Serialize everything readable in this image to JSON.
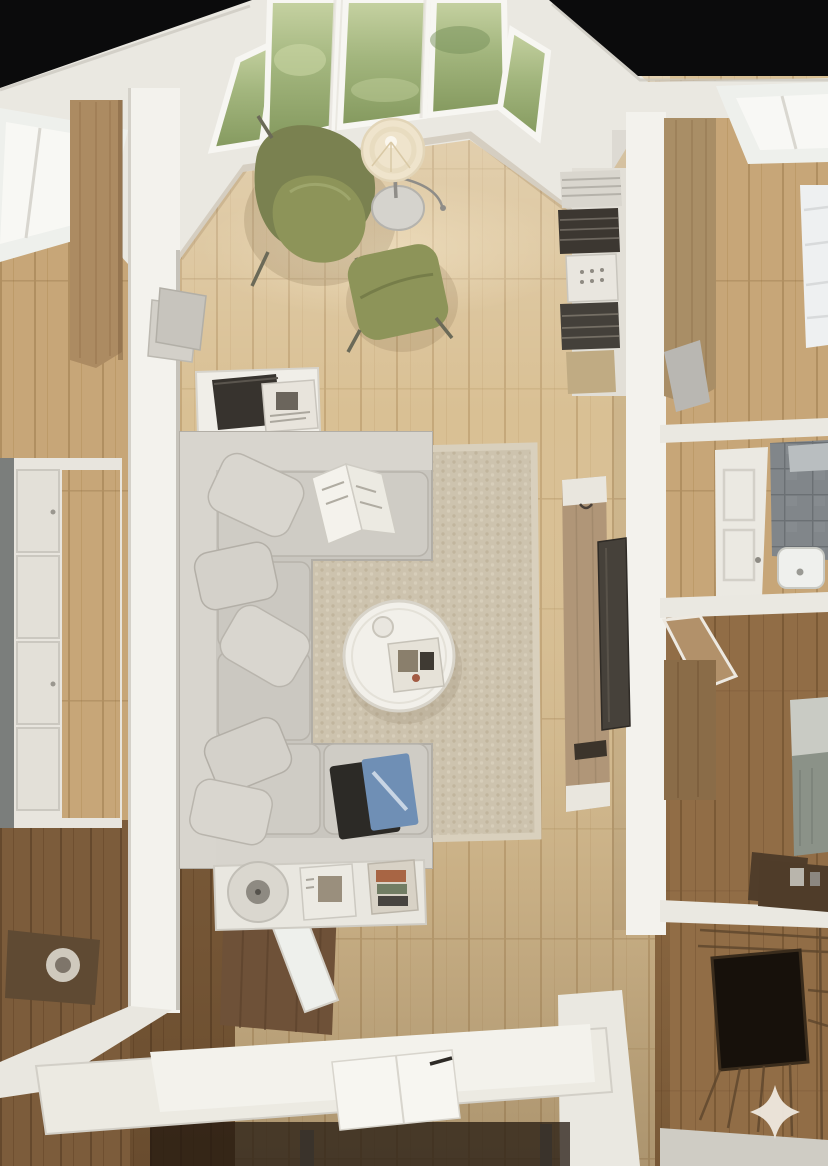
{
  "meta": {
    "type": "photorealistic-3d-render",
    "view": "top-down-birds-eye",
    "subject": "apartment interior with central living room, side bedrooms, bathroom and staircase",
    "width": 828,
    "height": 1166,
    "visible_text": ""
  },
  "palette": {
    "ceilingVoid": "#0b0b0c",
    "wallWhite": "#eae8e1",
    "wallBright": "#f3f2ed",
    "cornice": "#d6d3cb",
    "glassGreen": "#9fb37c",
    "windowFrame": "#f7f6f2",
    "floorLight": "#d9c094",
    "floorMid": "#c7a678",
    "floorDark": "#916d46",
    "floorEntry": "#7c5c3b",
    "rugBase": "#cdc3ae",
    "sofa": "#c9c6bf",
    "sofaLight": "#d8d5ce",
    "sofaShadow": "#a9a59d",
    "pillow": "#d9d6cf",
    "chairGreen": "#8d9459",
    "chairGreenDark": "#7a8150",
    "lampShade": "#efe4cc",
    "chrome": "#8f8d88",
    "tableWhite": "#f2f0ea",
    "tvPanelWood": "#b09678",
    "tvScreen": "#46413a",
    "bookshelfWhite": "#e2dfd7",
    "bookDark": "#3c3731",
    "bookTan": "#c0ab83",
    "bedWhite": "#eef0f1",
    "headboardSage": "#8b9288",
    "tileGray": "#81868a",
    "fixtureWhite": "#eff0ed",
    "doorWhite": "#ebe9e2",
    "cabinetDark": "#5f4a33",
    "deskWhite": "#eceae2",
    "stairVoid": "#17110b",
    "landingGray": "#cfccc4",
    "sparkle": "#efe9df",
    "tabletScreenBlue": "#6f8fb5"
  },
  "scene": {
    "rooms": [
      {
        "id": "living-room",
        "label": "central living room with bay window"
      },
      {
        "id": "left-bedroom",
        "label": "left room with window and wardrobe"
      },
      {
        "id": "hallway-closet",
        "label": "left hallway with paneled closets"
      },
      {
        "id": "entry",
        "label": "lower-left entry with dark floor"
      },
      {
        "id": "right-bedroom",
        "label": "upper-right bedroom with white bed"
      },
      {
        "id": "bathroom",
        "label": "right bathroom with gray tile"
      },
      {
        "id": "second-bedroom",
        "label": "lower-right bedroom with sage bed"
      },
      {
        "id": "staircase",
        "label": "winder staircase with dark stairwell void"
      }
    ],
    "objects": [
      {
        "id": "bay-window",
        "label": "angled bay window with greenery outside"
      },
      {
        "id": "floor-lamp",
        "label": "floor lamp with cream drum shade"
      },
      {
        "id": "armchair",
        "label": "olive green lounge armchair"
      },
      {
        "id": "ottoman",
        "label": "olive green ottoman"
      },
      {
        "id": "bookshelf",
        "label": "wall shelf stacked with books and magazines"
      },
      {
        "id": "console-table",
        "label": "white console with laptop and magazines"
      },
      {
        "id": "sectional-sofa",
        "label": "light gray L-shaped sectional sofa"
      },
      {
        "id": "open-book",
        "label": "open sketchbook on chaise"
      },
      {
        "id": "area-rug",
        "label": "beige woven area rug"
      },
      {
        "id": "coffee-table",
        "label": "round white coffee table with tray"
      },
      {
        "id": "tablet",
        "label": "tablet lying on sofa seat"
      },
      {
        "id": "media-shelf",
        "label": "low white shelf with speaker and magazines"
      },
      {
        "id": "tv-unit",
        "label": "wood tv panel with mounted television"
      },
      {
        "id": "desk",
        "label": "white desk with notebook and pen"
      },
      {
        "id": "stairwell",
        "label": "dark stair opening with winder steps"
      }
    ]
  },
  "watermark": {
    "icon": "four-pointed-star-sparkle"
  }
}
